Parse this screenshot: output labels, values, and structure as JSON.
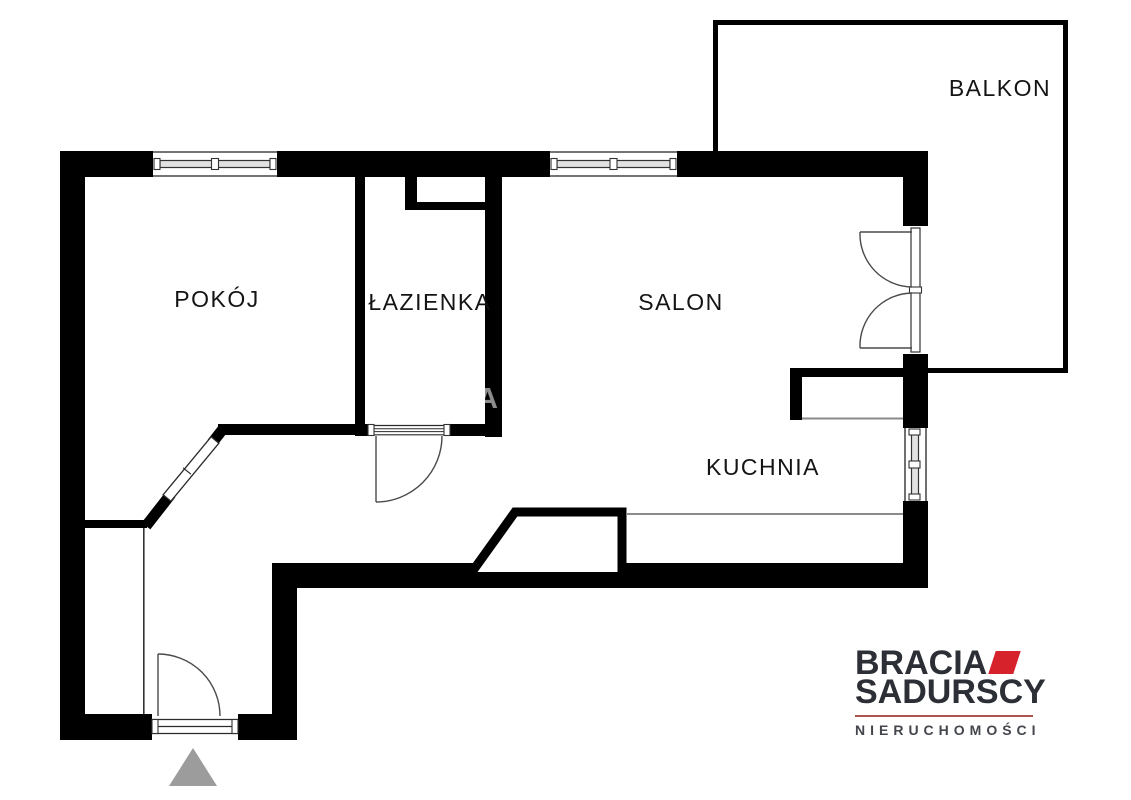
{
  "floorplan": {
    "rooms": [
      {
        "id": "pokoj",
        "label": "POKÓJ"
      },
      {
        "id": "lazienka",
        "label": "ŁAZIENKA"
      },
      {
        "id": "salon",
        "label": "SALON"
      },
      {
        "id": "kuchnia",
        "label": "KUCHNIA"
      },
      {
        "id": "balkon",
        "label": "BALKON"
      }
    ],
    "watermark_text": "A",
    "colors": {
      "wall": "#000000",
      "window_bar_fill": "#e2e2e2",
      "entrance_marker": "#9c9c9c"
    }
  },
  "branding": {
    "line1": "BRACIA",
    "line2": "SADURSCY",
    "tagline": "NIERUCHOMOŚCI",
    "accent_red": "#d6232b",
    "divider_red": "#a8564f"
  }
}
